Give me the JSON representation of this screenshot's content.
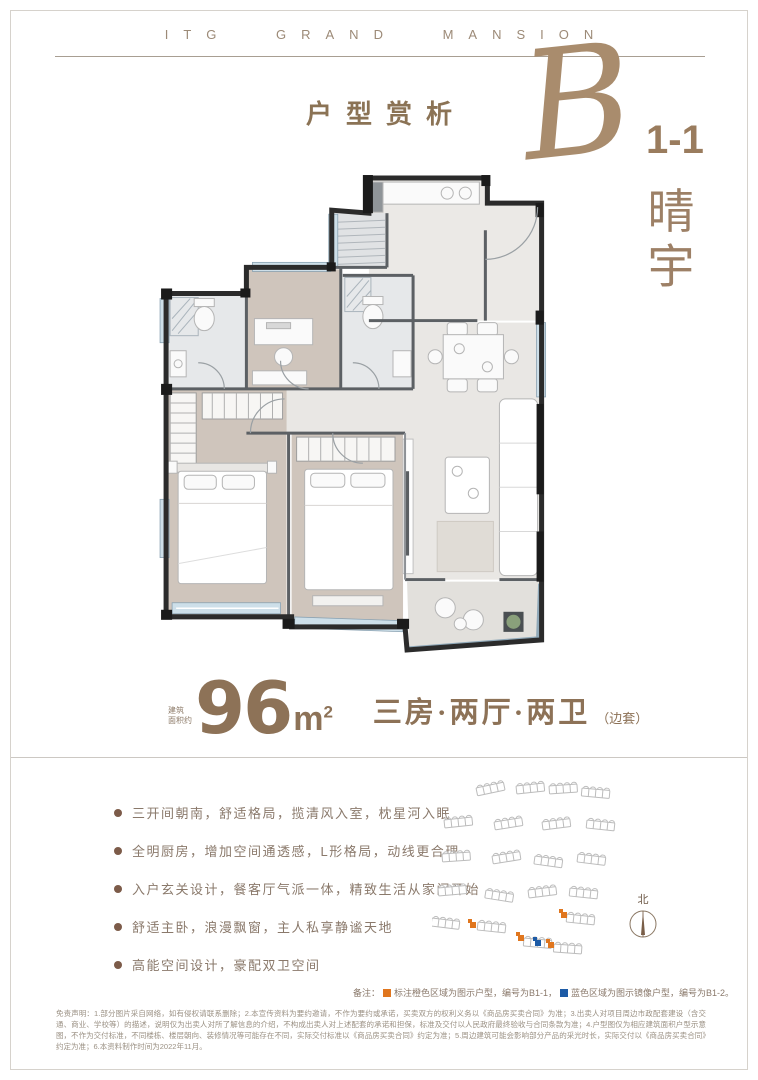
{
  "brand": {
    "name": "ITG GRAND MANSION"
  },
  "header": {
    "section_title": "户型赏析"
  },
  "unit": {
    "letter": "B",
    "number": "1-1",
    "name": "晴宇"
  },
  "area": {
    "prefix_line1": "建筑",
    "prefix_line2": "面积约",
    "value": "96",
    "unit": "m",
    "unit_exp": "2",
    "layout": "三房·两厅·两卫",
    "layout_note": "（边套）"
  },
  "features": [
    "三开间朝南，舒适格局，揽清风入室，枕星河入眠",
    "全明厨房，增加空间通透感，L形格局，动线更合理",
    "入户玄关设计，餐客厅气派一体，精致生活从家门开始",
    "舒适主卧，浪漫飘窗，主人私享静谧天地",
    "高能空间设计，豪配双卫空间"
  ],
  "siteplan": {
    "north_label": "北"
  },
  "legend": {
    "label": "备注：",
    "orange_text": "标注橙色区域为图示户型，编号为B1-1，",
    "blue_text": "蓝色区域为图示镜像户型，编号为B1-2。"
  },
  "disclaimer": "免责声明：1.部分图片采自网络，如有侵权请联系删除；2.本宣传资料为要约邀请，不作为要约或承诺，买卖双方的权利义务以《商品房买卖合同》为准；3.出卖人对项目周边市政配套建设（含交通、商业、学校等）的描述，说明仅为出卖人对所了解信息的介绍，不构成出卖人对上述配套的承诺和担保，标准及交付以人民政府最终验收与合同条款为准；4.户型图仅为相应建筑面积户型示意图，不作为交付标准，不同楼栋、楼层朝向、装修情况等可能存在不同，实际交付标准以《商品房买卖合同》约定为准；5.周边建筑可能会影响部分产品的采光时长，实际交付以《商品房买卖合同》约定为准；6.本资料制作时间为2022年11月。",
  "colors": {
    "brand_brown": "#8d7257",
    "accent_orange": "#e0761e",
    "accent_blue": "#1d5ba6"
  }
}
